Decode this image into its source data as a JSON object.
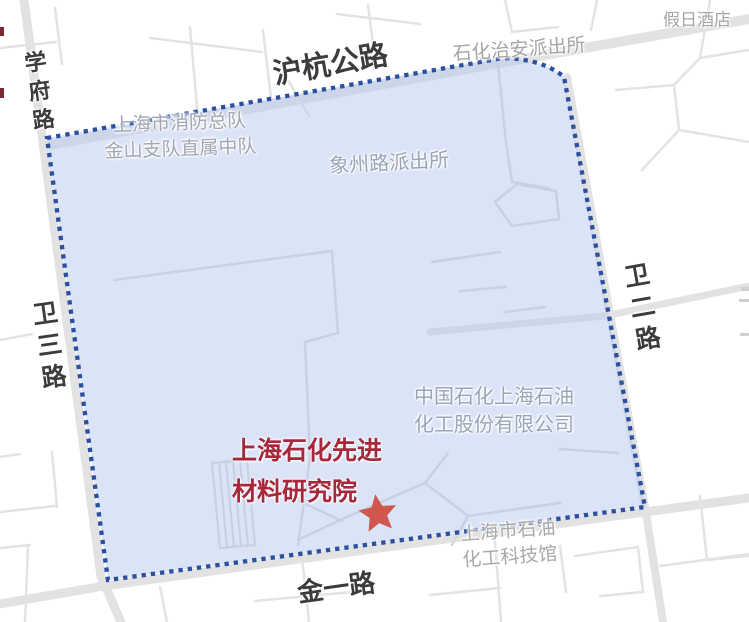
{
  "colors": {
    "region_fill": "rgba(186,201,240,0.52)",
    "region_border": "#2b50a0",
    "star": "#d0574e",
    "road_fill": "#e2e2e2",
    "road_label": "#3c3c3c",
    "poi_label_inside": "#99a3ba",
    "poi_label_outside": "#a5a5a5",
    "highlight_label": "#a6293b"
  },
  "map": {
    "road_labels": [
      {
        "id": "huhang-gonglu",
        "text": "沪杭公路"
      },
      {
        "id": "xuefu-lu",
        "text": "学府路"
      },
      {
        "id": "weisan-lu",
        "text": "卫三路"
      },
      {
        "id": "weier-lu",
        "text": "卫二路"
      },
      {
        "id": "jinyi-lu",
        "text": "金一路"
      }
    ],
    "poi_labels": [
      {
        "id": "holiday-hotel",
        "text": "假日酒店"
      },
      {
        "id": "shihua-police-station",
        "text": "石化治安派出所"
      },
      {
        "id": "fire-brigade",
        "line1": "上海市消防总队",
        "line2": "金山支队直属中队"
      },
      {
        "id": "xiangzhou-police-station",
        "text": "象州路派出所"
      },
      {
        "id": "sinopec-company",
        "line1": "中国石化上海石油",
        "line2": "化工股份有限公司"
      },
      {
        "id": "science-museum",
        "line1": "上海市石油",
        "line2": "化工科技馆"
      }
    ],
    "highlight": {
      "line1": "上海石化先进",
      "line2": "材料研究院",
      "marker": "star"
    }
  }
}
